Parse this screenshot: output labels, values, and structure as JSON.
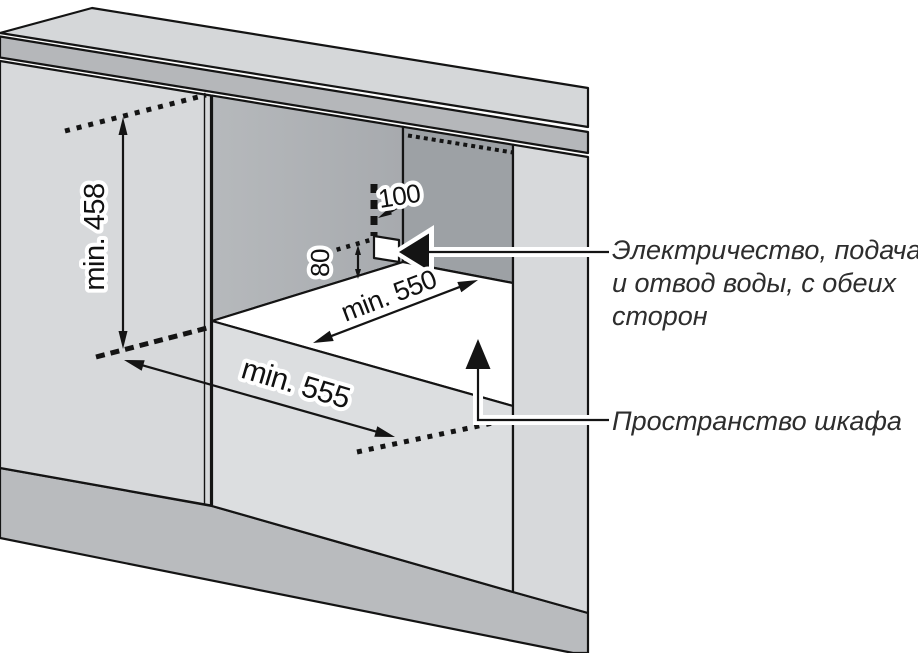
{
  "diagram": {
    "type": "appliance-niche-installation-drawing",
    "dims": {
      "niche_height": "min. 458",
      "niche_width_front": "min. 555",
      "niche_depth": "min. 550",
      "connection_offset_side": "100",
      "connection_offset_bottom": "80"
    },
    "callouts": {
      "utilities": {
        "line1": "Электричество, подача",
        "line2": "и отвод воды, с обеих",
        "line3": "сторон"
      },
      "cabinet_space": {
        "text": "Пространство шкафа"
      }
    },
    "colors": {
      "bg": "#ffffff",
      "counter": "#d5d7d9",
      "band": "#b5b7ba",
      "panel": "#d7d9db",
      "panel_light": "#dcdee0",
      "back_wall": "#b6b9bc",
      "back_wall_dark": "#a7aaae",
      "side_wall": "#9da1a5",
      "plinth": "#b9bbbe",
      "floor": "#ffffff",
      "outline": "#141414",
      "label": "#111111",
      "callout": "#2d2d2d"
    }
  }
}
